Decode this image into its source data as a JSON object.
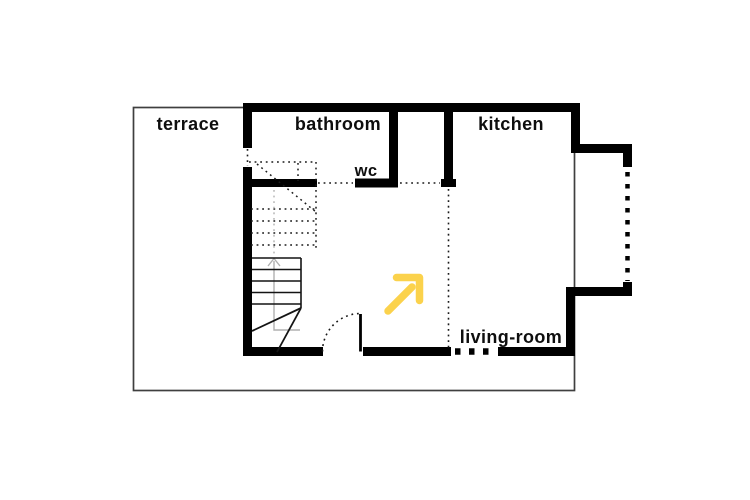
{
  "plan": {
    "title": "floor-plan",
    "labels": {
      "terrace": "terrace",
      "bathroom": "bathroom",
      "wc": "wc",
      "kitchen": "kitchen",
      "living_room": "living-room"
    },
    "colors": {
      "background": "#ffffff",
      "wall": "#000000",
      "outline": "#3f3f3f",
      "dotted": "#1a1a1a",
      "stair": "#141414",
      "walkline": "#b0b0b0",
      "arrow": "#fbd24c",
      "text": "#0e0e0e"
    },
    "icons": {
      "direction_arrow": "up-right-arrow",
      "stair_direction": "chevron-up"
    }
  }
}
